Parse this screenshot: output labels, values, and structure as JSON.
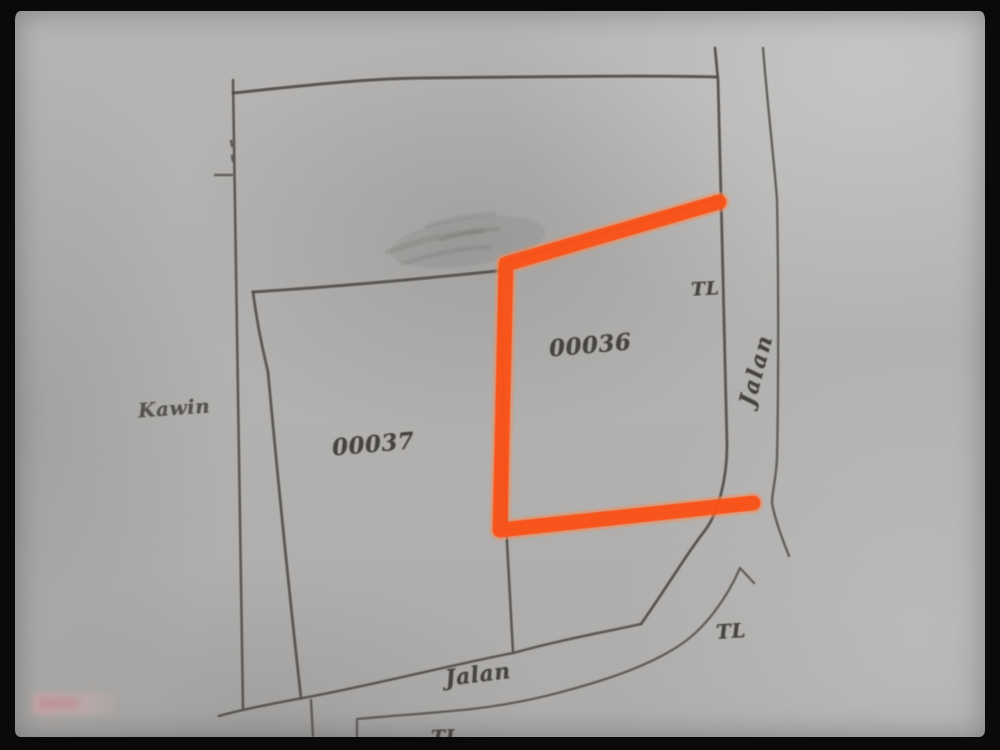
{
  "photo": {
    "description": "scanned hand-drawn cadastral sketch map"
  },
  "map": {
    "parcels": [
      {
        "id": "00036",
        "highlighted": true
      },
      {
        "id": "00037",
        "highlighted": false
      }
    ],
    "area_label": "Kawin",
    "roads": [
      {
        "name": "Jalan",
        "position": "right",
        "orientation": "vertical"
      },
      {
        "name": "Jalan",
        "position": "bottom",
        "orientation": "horizontal"
      }
    ],
    "markers": [
      {
        "label": "TL",
        "position": "upper-right"
      },
      {
        "label": "TL",
        "position": "lower-right"
      },
      {
        "label": "TL",
        "position": "bottom-center"
      }
    ]
  },
  "colors": {
    "highlight_orange": "#fb4f17",
    "highlight_glow": "#ff8a4d",
    "pencil_ink": "#4c4a47",
    "paper_gray": "#b3b1af",
    "frame_black": "#0a0a0a",
    "watermark_pink": "#d6a0a5"
  }
}
